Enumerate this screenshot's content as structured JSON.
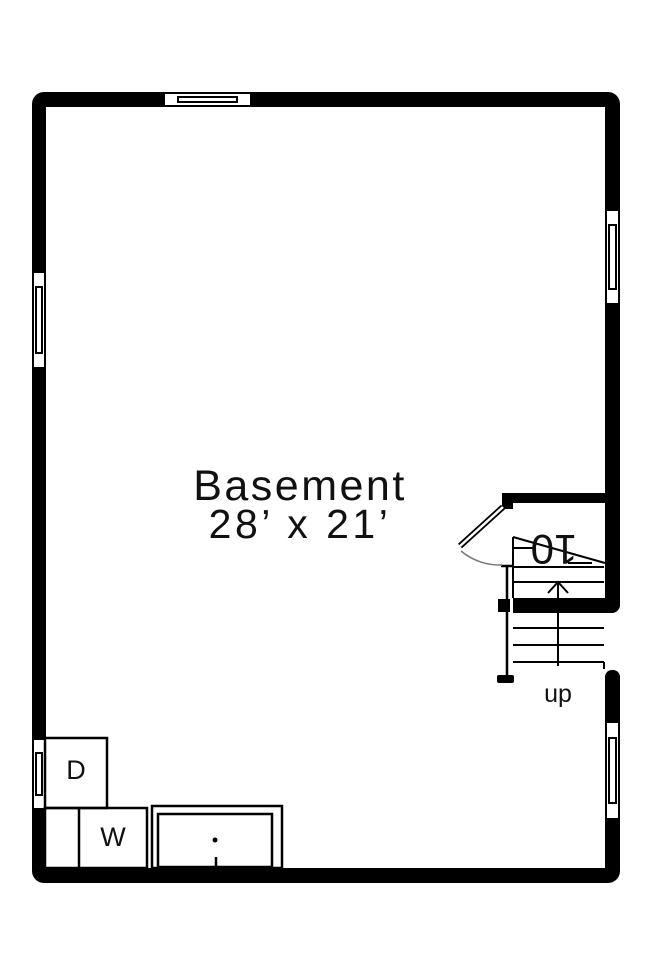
{
  "title": "Basement floor plan",
  "room": {
    "name": "Basement",
    "dimensions": "28’ x 21’"
  },
  "stairs": {
    "direction_label": "up",
    "riser_count_label": "10"
  },
  "appliances": {
    "dryer_label": "D",
    "washer_label": "W"
  },
  "colors": {
    "wall": "#000000",
    "background": "#ffffff",
    "line": "#000000",
    "door_swing": "#777777"
  }
}
